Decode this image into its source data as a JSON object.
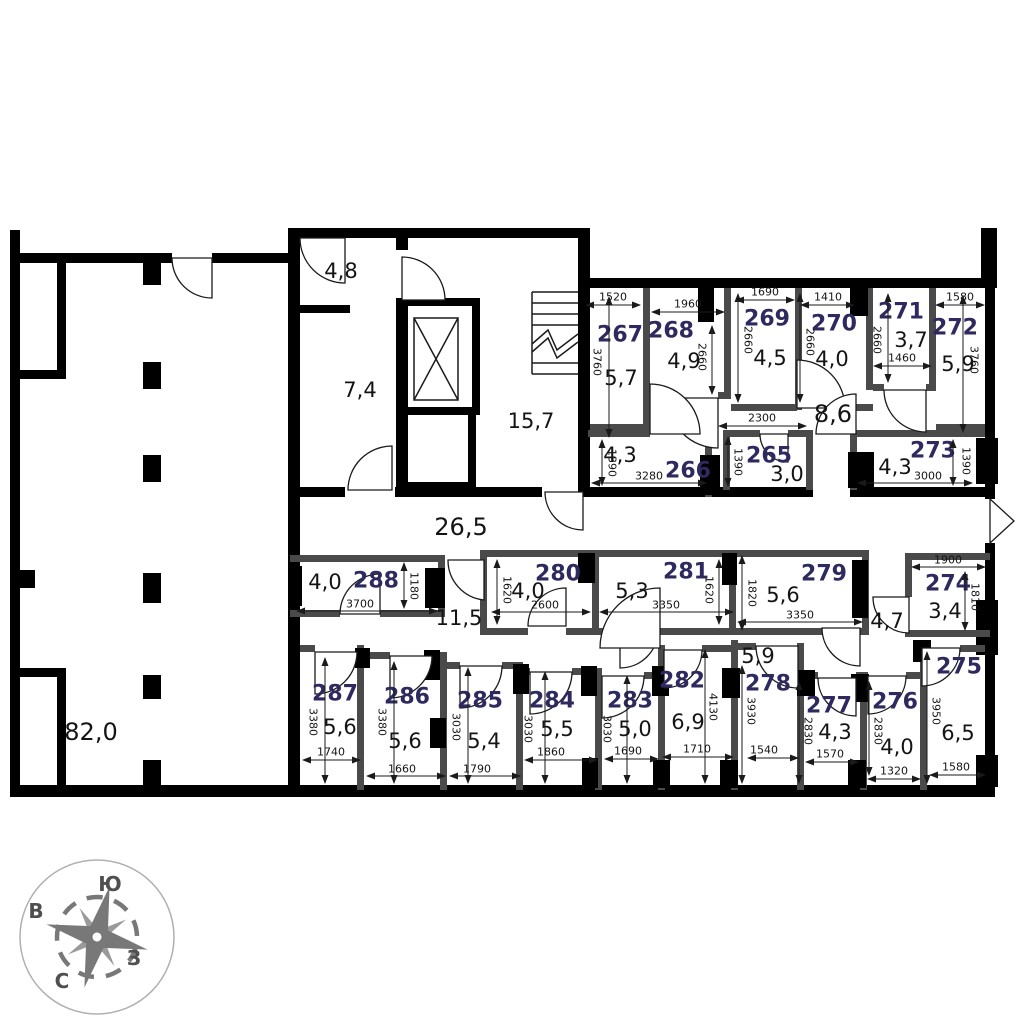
{
  "plan": {
    "big_room_area": "82,0",
    "core": {
      "entry_area": "4,8",
      "hall_area": "7,4",
      "stair_area": "15,7"
    },
    "corridors": {
      "main": "26,5",
      "west": "11,5",
      "north": "8,6",
      "east": "4,7"
    },
    "rooms": {
      "r265": {
        "number": "265",
        "area": "3,0",
        "dim_w": "2300",
        "dim_h": "1390"
      },
      "r266": {
        "number": "266",
        "area": "4,3",
        "dim_w": "3280",
        "dim_h": "1390"
      },
      "r267": {
        "number": "267",
        "area": "5,7",
        "dim_w": "1520",
        "dim_h": "3760"
      },
      "r268": {
        "number": "268",
        "area": "4,9",
        "dim_w": "1960",
        "dim_h": "2660"
      },
      "r269": {
        "number": "269",
        "area": "4,5",
        "dim_w": "1690",
        "dim_h": "2660"
      },
      "r270": {
        "number": "270",
        "area": "4,0",
        "dim_w": "1410",
        "dim_h": "2660"
      },
      "r271": {
        "number": "271",
        "area": "3,7",
        "dim_w": "1460",
        "dim_h": "2660"
      },
      "r272": {
        "number": "272",
        "area": "5,9",
        "dim_w": "1580",
        "dim_h": "3760"
      },
      "r273": {
        "number": "273",
        "area": "4,3",
        "dim_w": "3000",
        "dim_h": "1390"
      },
      "r274": {
        "number": "274",
        "area": "3,4",
        "dim_w": "1900",
        "dim_h": "1810"
      },
      "r275": {
        "number": "275",
        "area": "6,5",
        "dim_w": "1580",
        "dim_h": "3950"
      },
      "r276": {
        "number": "276",
        "area": "4,0",
        "dim_w": "1320",
        "dim_h": "2830"
      },
      "r277": {
        "number": "277",
        "area": "4,3",
        "dim_w": "1570",
        "dim_h": "2830"
      },
      "r278": {
        "number": "278",
        "area": "5,9",
        "dim_w": "1540",
        "dim_h": "3930"
      },
      "r279": {
        "number": "279",
        "area": "5,6",
        "dim_w": "3350",
        "dim_h": "1820"
      },
      "r280": {
        "number": "280",
        "area": "4,0",
        "dim_w": "2600",
        "dim_h": "1620"
      },
      "r281": {
        "number": "281",
        "area": "5,3",
        "dim_w": "3350",
        "dim_h": "1620"
      },
      "r282": {
        "number": "282",
        "area": "6,9",
        "dim_w": "1710",
        "dim_h": "4130"
      },
      "r283": {
        "number": "283",
        "area": "5,0",
        "dim_w": "1690",
        "dim_h": "3030"
      },
      "r284": {
        "number": "284",
        "area": "5,5",
        "dim_w": "1860",
        "dim_h": "3030"
      },
      "r285": {
        "number": "285",
        "area": "5,4",
        "dim_w": "1790",
        "dim_h": "3030"
      },
      "r286": {
        "number": "286",
        "area": "5,6",
        "dim_w": "1660",
        "dim_h": "3380"
      },
      "r287": {
        "number": "287",
        "area": "5,6",
        "dim_w": "1740",
        "dim_h": "3380"
      },
      "r288": {
        "number": "288",
        "area": "4,0",
        "dim_w": "3700",
        "dim_h": "1180"
      }
    },
    "compass": {
      "south": "Ю",
      "east": "В",
      "west": "З",
      "north": "С"
    },
    "colors": {
      "room_number": "#2e2a5f",
      "walls": "#000000",
      "partitions": "#4a4a4a",
      "compass": "#7a7a7a"
    }
  }
}
